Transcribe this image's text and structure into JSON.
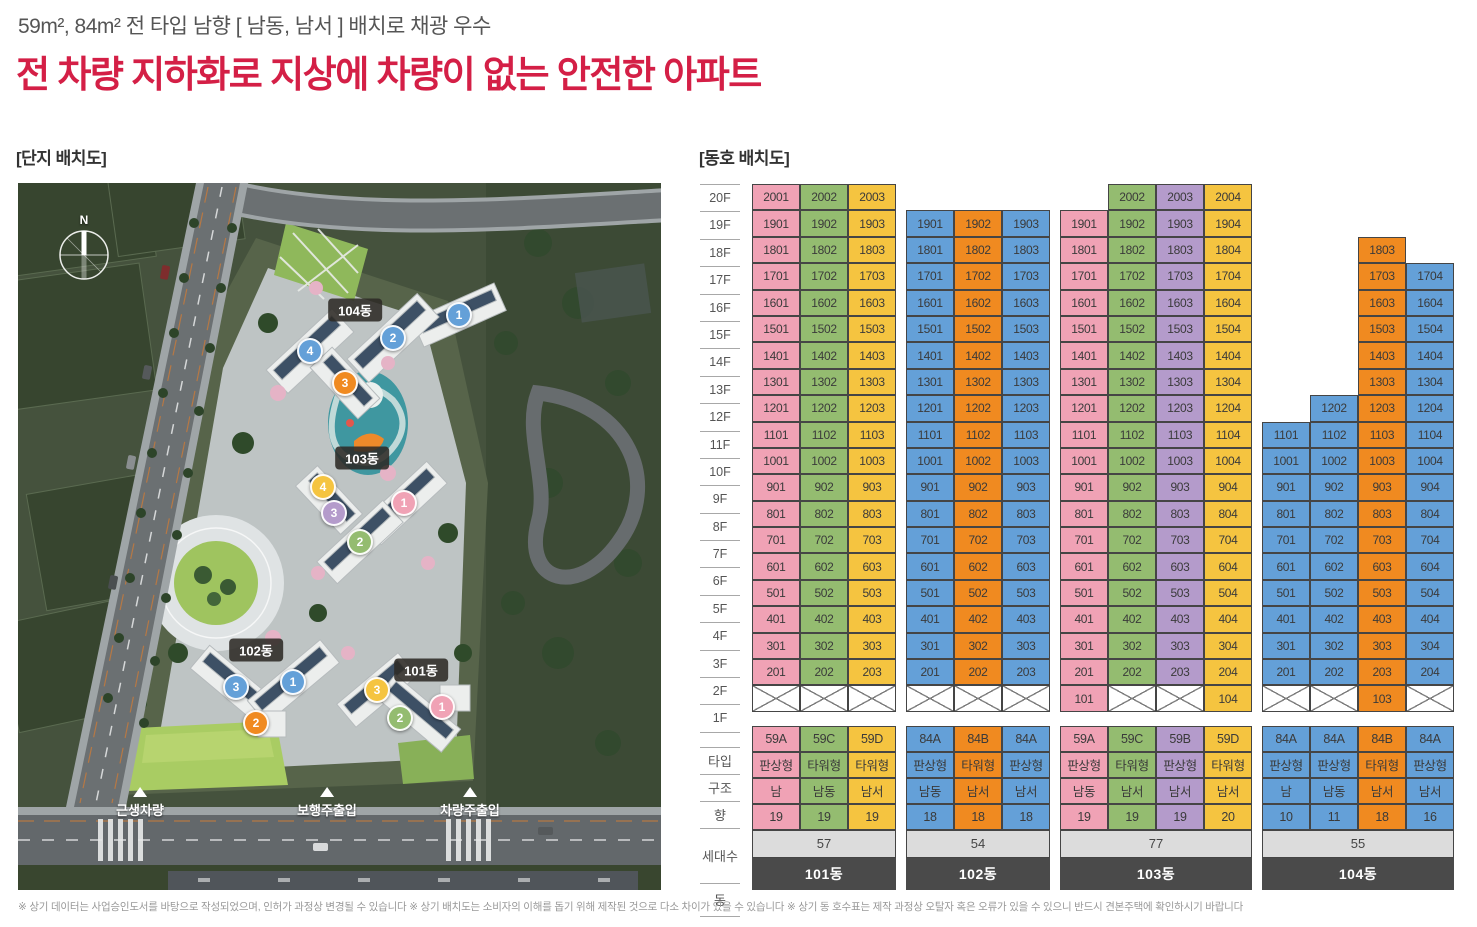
{
  "header": {
    "subtitle": "59m², 84m² 전 타입 남향 [ 남동, 남서 ] 배치로 채광 우수",
    "title": "전 차량 지하화로 지상에 차량이 없는 안전한 아파트",
    "title_color": "#D41F46"
  },
  "sections": {
    "site_plan_label": "[단지 배치도]",
    "unit_plan_label": "[동호 배치도]"
  },
  "site_plan": {
    "compass_label": "N",
    "building_labels": [
      {
        "name": "104동",
        "x": 337,
        "y": 127,
        "units": [
          {
            "no": "1",
            "color": "blue",
            "x": 441,
            "y": 132
          },
          {
            "no": "2",
            "color": "blue",
            "x": 375,
            "y": 155
          },
          {
            "no": "3",
            "color": "orange",
            "x": 327,
            "y": 200
          },
          {
            "no": "4",
            "color": "blue",
            "x": 292,
            "y": 168
          }
        ]
      },
      {
        "name": "103동",
        "x": 344,
        "y": 275,
        "units": [
          {
            "no": "1",
            "color": "pink",
            "x": 386,
            "y": 320
          },
          {
            "no": "2",
            "color": "green",
            "x": 342,
            "y": 359
          },
          {
            "no": "3",
            "color": "purple",
            "x": 316,
            "y": 330
          },
          {
            "no": "4",
            "color": "yellow",
            "x": 305,
            "y": 304
          }
        ]
      },
      {
        "name": "102동",
        "x": 238,
        "y": 467,
        "units": [
          {
            "no": "1",
            "color": "blue",
            "x": 275,
            "y": 499
          },
          {
            "no": "2",
            "color": "orange",
            "x": 238,
            "y": 540
          },
          {
            "no": "3",
            "color": "blue",
            "x": 218,
            "y": 504
          }
        ]
      },
      {
        "name": "101동",
        "x": 403,
        "y": 487,
        "units": [
          {
            "no": "1",
            "color": "pink",
            "x": 424,
            "y": 524
          },
          {
            "no": "2",
            "color": "green",
            "x": 382,
            "y": 535
          },
          {
            "no": "3",
            "color": "yellow",
            "x": 359,
            "y": 507
          }
        ]
      }
    ],
    "entrances": [
      {
        "label": "근생차량",
        "x": 122
      },
      {
        "label": "보행주출입",
        "x": 309
      },
      {
        "label": "차량주출입",
        "x": 452
      }
    ]
  },
  "unit_table": {
    "floors": [
      "20F",
      "19F",
      "18F",
      "17F",
      "16F",
      "15F",
      "14F",
      "13F",
      "12F",
      "11F",
      "10F",
      "9F",
      "8F",
      "7F",
      "6F",
      "5F",
      "4F",
      "3F",
      "2F",
      "1F"
    ],
    "row_labels": {
      "type": "타입",
      "structure": "구조",
      "direction": "향",
      "households": "세대수",
      "building": "동"
    },
    "colors": {
      "pink": "#F0A2B5",
      "green": "#94BC70",
      "yellow": "#F5C440",
      "blue": "#64A0D8",
      "purple": "#B49BCB",
      "orange": "#F08A20",
      "total_bg": "#DCDCDC",
      "building_bg": "#4A4A4A"
    },
    "buildings": [
      {
        "name": "101동",
        "total": "57",
        "columns": [
          {
            "color": "pink",
            "type": "59A",
            "structure": "판상형",
            "direction": "남",
            "households": "19",
            "first_floor": "X",
            "units": [
              "2001",
              "1901",
              "1801",
              "1701",
              "1601",
              "1501",
              "1401",
              "1301",
              "1201",
              "1101",
              "1001",
              "901",
              "801",
              "701",
              "601",
              "501",
              "401",
              "301",
              "201"
            ]
          },
          {
            "color": "green",
            "type": "59C",
            "structure": "타워형",
            "direction": "남동",
            "households": "19",
            "first_floor": "X",
            "units": [
              "2002",
              "1902",
              "1802",
              "1702",
              "1602",
              "1502",
              "1402",
              "1302",
              "1202",
              "1102",
              "1002",
              "902",
              "802",
              "702",
              "602",
              "502",
              "402",
              "302",
              "202"
            ]
          },
          {
            "color": "yellow",
            "type": "59D",
            "structure": "타워형",
            "direction": "남서",
            "households": "19",
            "first_floor": "X",
            "units": [
              "2003",
              "1903",
              "1803",
              "1703",
              "1603",
              "1503",
              "1403",
              "1303",
              "1203",
              "1103",
              "1003",
              "903",
              "803",
              "703",
              "603",
              "503",
              "403",
              "303",
              "203"
            ]
          }
        ]
      },
      {
        "name": "102동",
        "total": "54",
        "columns": [
          {
            "color": "blue",
            "type": "84A",
            "structure": "판상형",
            "direction": "남동",
            "households": "18",
            "first_floor": "X",
            "units": [
              "1901",
              "1801",
              "1701",
              "1601",
              "1501",
              "1401",
              "1301",
              "1201",
              "1101",
              "1001",
              "901",
              "801",
              "701",
              "601",
              "501",
              "401",
              "301",
              "201"
            ]
          },
          {
            "color": "orange",
            "type": "84B",
            "structure": "타워형",
            "direction": "남서",
            "households": "18",
            "first_floor": "X",
            "units": [
              "1902",
              "1802",
              "1702",
              "1602",
              "1502",
              "1402",
              "1302",
              "1202",
              "1102",
              "1002",
              "902",
              "802",
              "702",
              "602",
              "502",
              "402",
              "302",
              "202"
            ]
          },
          {
            "color": "blue",
            "type": "84A",
            "structure": "판상형",
            "direction": "남서",
            "households": "18",
            "first_floor": "X",
            "units": [
              "1903",
              "1803",
              "1703",
              "1603",
              "1503",
              "1403",
              "1303",
              "1203",
              "1103",
              "1003",
              "903",
              "803",
              "703",
              "603",
              "503",
              "403",
              "303",
              "203"
            ]
          }
        ]
      },
      {
        "name": "103동",
        "total": "77",
        "columns": [
          {
            "color": "pink",
            "type": "59A",
            "structure": "판상형",
            "direction": "남동",
            "households": "19",
            "first_floor": "101",
            "units": [
              "1901",
              "1801",
              "1701",
              "1601",
              "1501",
              "1401",
              "1301",
              "1201",
              "1101",
              "1001",
              "901",
              "801",
              "701",
              "601",
              "501",
              "401",
              "301",
              "201"
            ]
          },
          {
            "color": "green",
            "type": "59C",
            "structure": "타워형",
            "direction": "남서",
            "households": "19",
            "first_floor": "X",
            "units": [
              "2002",
              "1902",
              "1802",
              "1702",
              "1602",
              "1502",
              "1402",
              "1302",
              "1202",
              "1102",
              "1002",
              "902",
              "802",
              "702",
              "602",
              "502",
              "402",
              "302",
              "202"
            ]
          },
          {
            "color": "purple",
            "type": "59B",
            "structure": "판상형",
            "direction": "남서",
            "households": "19",
            "first_floor": "X",
            "units": [
              "2003",
              "1903",
              "1803",
              "1703",
              "1603",
              "1503",
              "1403",
              "1303",
              "1203",
              "1103",
              "1003",
              "903",
              "803",
              "703",
              "603",
              "503",
              "403",
              "303",
              "203"
            ]
          },
          {
            "color": "yellow",
            "type": "59D",
            "structure": "타워형",
            "direction": "남서",
            "households": "20",
            "first_floor": "104",
            "units": [
              "2004",
              "1904",
              "1804",
              "1704",
              "1604",
              "1504",
              "1404",
              "1304",
              "1204",
              "1104",
              "1004",
              "904",
              "804",
              "704",
              "604",
              "504",
              "404",
              "304",
              "204"
            ]
          }
        ]
      },
      {
        "name": "104동",
        "total": "55",
        "columns": [
          {
            "color": "blue",
            "type": "84A",
            "structure": "판상형",
            "direction": "남",
            "households": "10",
            "first_floor": "X",
            "units": [
              "1101",
              "1001",
              "901",
              "801",
              "701",
              "601",
              "501",
              "401",
              "301",
              "201"
            ]
          },
          {
            "color": "blue",
            "type": "84A",
            "structure": "판상형",
            "direction": "남동",
            "households": "11",
            "first_floor": "X",
            "units": [
              "1202",
              "1102",
              "1002",
              "902",
              "802",
              "702",
              "602",
              "502",
              "402",
              "302",
              "202"
            ]
          },
          {
            "color": "orange",
            "type": "84B",
            "structure": "타워형",
            "direction": "남서",
            "households": "18",
            "first_floor": "103",
            "units": [
              "1803",
              "1703",
              "1603",
              "1503",
              "1403",
              "1303",
              "1203",
              "1103",
              "1003",
              "903",
              "803",
              "703",
              "603",
              "503",
              "403",
              "303",
              "203"
            ]
          },
          {
            "color": "blue",
            "type": "84A",
            "structure": "판상형",
            "direction": "남서",
            "households": "16",
            "first_floor": "X",
            "units": [
              "1704",
              "1604",
              "1504",
              "1404",
              "1304",
              "1204",
              "1104",
              "1004",
              "904",
              "804",
              "704",
              "604",
              "504",
              "404",
              "304",
              "204"
            ]
          }
        ]
      }
    ]
  },
  "footnote": "※ 상기 데이터는 사업승인도서를 바탕으로 작성되었으며, 인허가 과정상 변경될 수 있습니다 ※ 상기 배치도는 소비자의 이해를 돕기 위해 제작된 것으로 다소 차이가 있을 수 있습니다 ※ 상기 동 호수표는 제작 과정상 오탈자 혹은 오류가 있을 수 있으니 반드시 견본주택에 확인하시기 바랍니다"
}
